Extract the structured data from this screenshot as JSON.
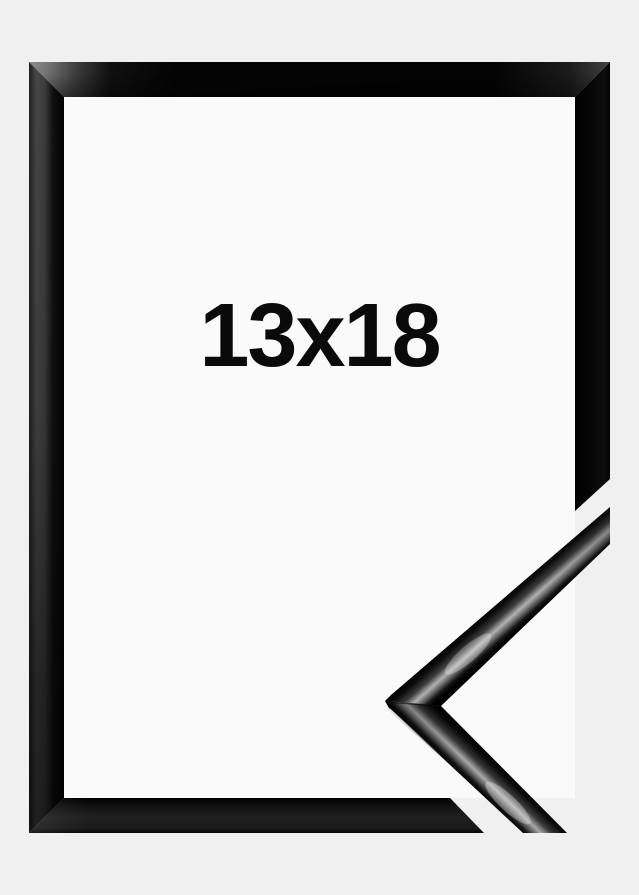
{
  "product": {
    "size_label": "13x18",
    "subject": "Glossy black picture frame shown with a corner profile sample cutaway in the lower right"
  },
  "colors": {
    "page_background": "#f0f0f1",
    "frame_interior": "#fafafa",
    "frame_gloss_black": "#070707",
    "reflection_gray": "#b2b2b2",
    "label_text": "#0a0a0a"
  }
}
